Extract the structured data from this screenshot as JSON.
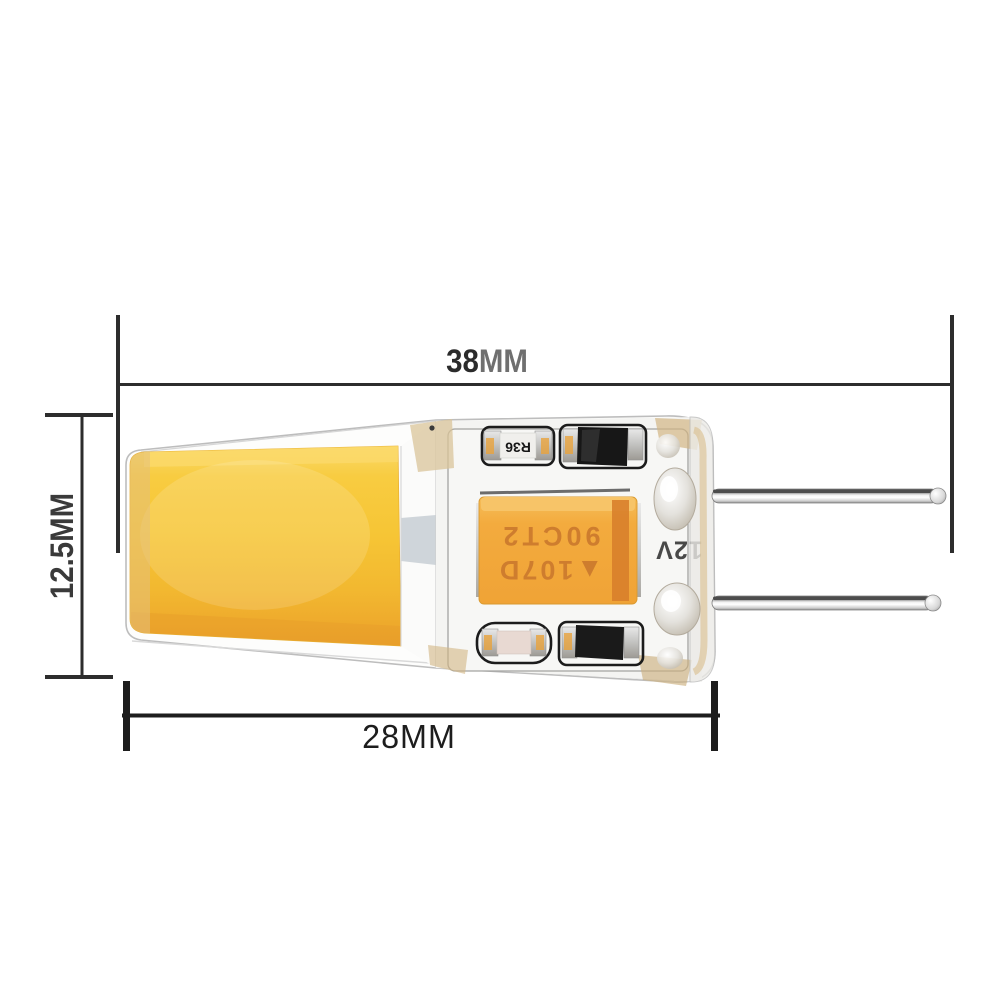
{
  "diagram": {
    "dimensions": {
      "overall_length": {
        "value": "38",
        "unit": "MM"
      },
      "height": {
        "value": "12.5",
        "unit": "MM"
      },
      "body_length": {
        "value": "28",
        "unit": "MM"
      }
    },
    "pcb_markings": {
      "resistor": "R36",
      "capacitor_line1": "▲107D",
      "capacitor_line2": "90CT2",
      "board_voltage": "12V"
    },
    "colors": {
      "dimension_line": "#2d2d2d",
      "label_dark": "#2b2b2b",
      "label_unit_gray": "#6f6f6f",
      "cob_yellow": "#F6C535",
      "cob_deep": "#EDA72C",
      "capacitor_orange": "#F3A93C",
      "capacitor_stripe": "#D8802B",
      "capacitor_text": "#CE7D2E",
      "silicone_edge": "#bdbdbd"
    }
  }
}
